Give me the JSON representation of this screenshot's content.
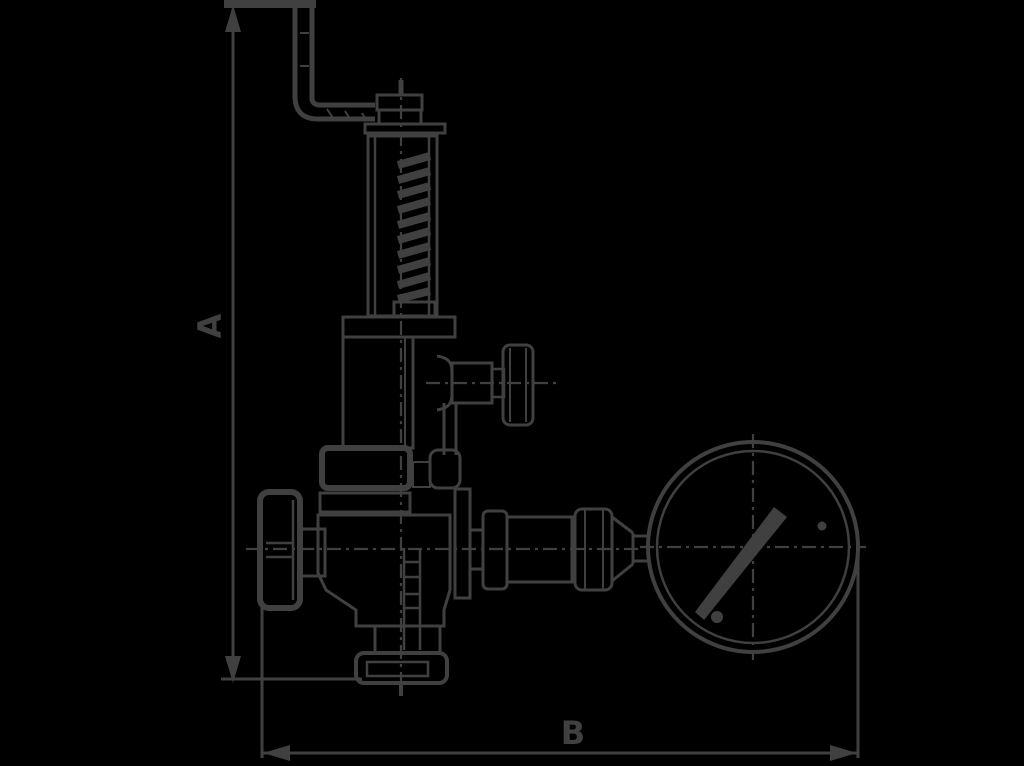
{
  "canvas": {
    "width": 1024,
    "height": 766,
    "background_color": "#000000",
    "line_color": "#404040"
  },
  "drawing": {
    "kind": "valve-dimension-diagram",
    "description": "Side-view technical line drawing of a safety valve with bent test lever, spring bonnet, handwheel, side outlet knob, bottom flange connection and an attached pressure gauge, annotated with overall height and width dimension lines",
    "dimension_a": {
      "label": "A",
      "orientation": "vertical"
    },
    "dimension_b": {
      "label": "B",
      "orientation": "horizontal"
    },
    "gauge": {
      "rings": 2,
      "needle_angle_deg": -46,
      "has_crosshair_centerlines": true
    },
    "components": [
      "test-lever",
      "adjustment-pin",
      "adjustment-cap",
      "spring-bonnet",
      "spring",
      "bonnet-flange",
      "side-outlet",
      "outlet-knob",
      "handwheel",
      "handwheel-stem",
      "valve-body",
      "outlet-neck",
      "bottom-flange",
      "gauge-fittings",
      "pressure-gauge",
      "gauge-needle",
      "centerlines",
      "dimension-line-a",
      "dimension-line-b"
    ]
  }
}
